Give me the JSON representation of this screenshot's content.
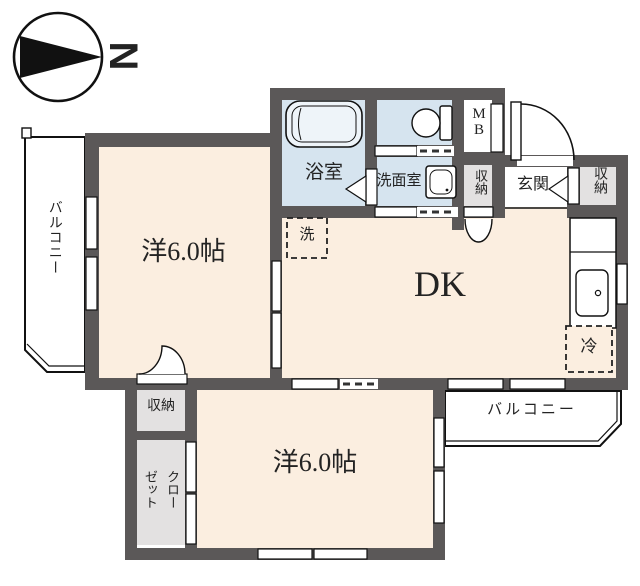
{
  "compass": {
    "north": "N"
  },
  "plan": {
    "balcony_left": "バルコニー",
    "balcony_bottom": "バルコニー",
    "room_top": "洋6.0帖",
    "room_bottom": "洋6.0帖",
    "dk": "DK",
    "bathroom": "浴室",
    "washroom": "洗面室",
    "entrance": "玄関",
    "meter_box": "MB",
    "storage_left": "収納",
    "storage_right": "収納",
    "storage_bottom": "収納",
    "closet": "クローゼット",
    "washer": "洗",
    "fridge": "冷"
  },
  "colors": {
    "wall": "#5b5858",
    "floor_cream": "#fbeee0",
    "floor_blue": "#d6e4ef",
    "floor_gray": "#e3e1e1",
    "line": "#111111"
  }
}
